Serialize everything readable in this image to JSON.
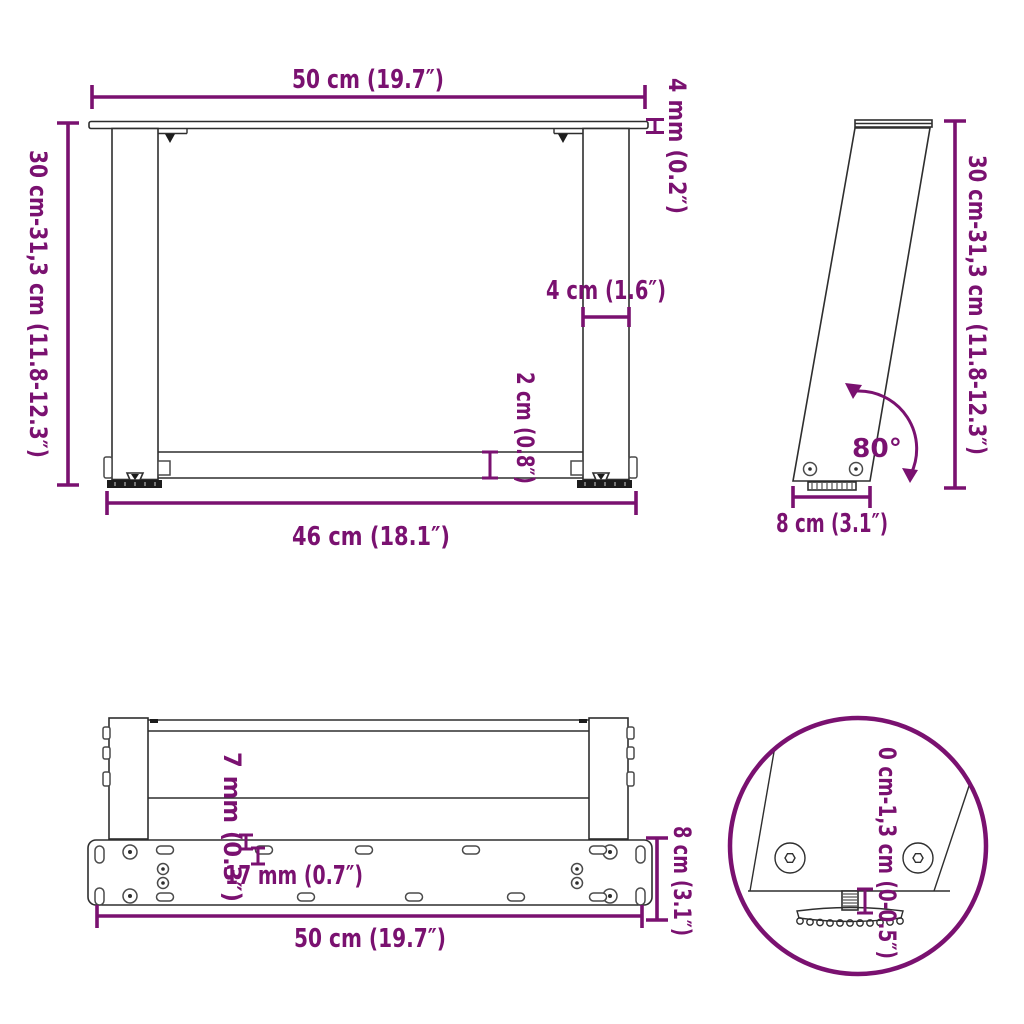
{
  "colors": {
    "accent": "#7A1170",
    "line": "#2E2E2E",
    "background": "#FFFFFF"
  },
  "views": {
    "front": {
      "labels": {
        "width_top": "50 cm (19.7″)",
        "plate_thickness": "4 mm (0.2″)",
        "height": "30 cm-31,3 cm (11.8-12.3″)",
        "leg_width": "4 cm (1.6″)",
        "crossbar_height": "2 cm (0.8″)",
        "width_bottom": "46 cm (18.1″)"
      }
    },
    "side": {
      "labels": {
        "height": "30 cm-31,3 cm (11.8-12.3″)",
        "angle": "80°",
        "base_depth": "8 cm (3.1″)"
      }
    },
    "top": {
      "labels": {
        "hole_diameter": "7 mm (0.3″)",
        "hole_pitch": "17 mm (0.7″)",
        "plate_depth": "8 cm (3.1″)",
        "plate_width": "50 cm (19.7″)"
      }
    },
    "detail": {
      "labels": {
        "adjustable_range": "0 cm-1,3 cm (0-0.5″)"
      }
    }
  }
}
